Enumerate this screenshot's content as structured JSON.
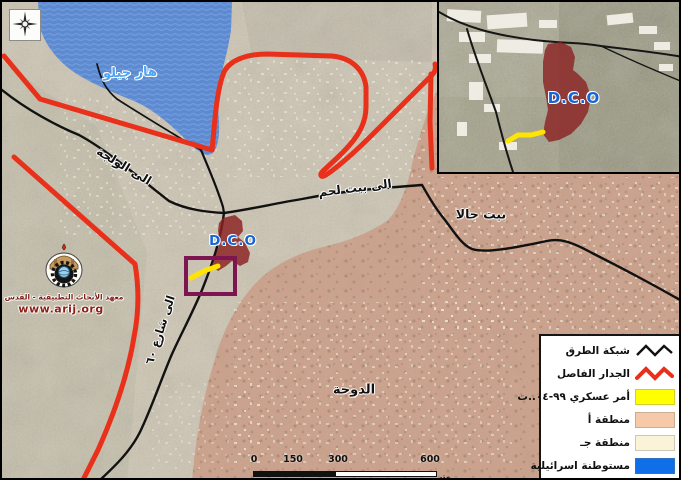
{
  "map": {
    "labels": {
      "har_gilo": "هار جيلو",
      "dco": "D.C.O",
      "to_walaja": "الى الولجة",
      "to_bethlehem": "الى بيت لحم",
      "beit_jala": "بيت جالا",
      "doha": "الدوحة",
      "to_road_60": "الى شارع ٦٠"
    },
    "colors": {
      "separation_wall": "#e8301a",
      "road_network": "#111111",
      "settlement_fill": "#4d82d4",
      "area_a_fill": "#c98268",
      "dco_compound": "#8b2121",
      "military_order_line": "#ffe400",
      "order_box_outline": "#7c1550",
      "label_blue": "#1565d8"
    }
  },
  "inset": {
    "dco_label": "D.C.O"
  },
  "logo": {
    "org_name": "معهد الأبحاث التطبيقية - القدس",
    "website": "www.arij.org"
  },
  "legend": {
    "items": [
      {
        "label": "شبكة الطرق",
        "symbol": "black-zigzag-line",
        "color": "#111111"
      },
      {
        "label": "الجدار الفاصل",
        "symbol": "red-zigzag-line",
        "color": "#e8301a"
      },
      {
        "label": "أمر عسكري ٩٩-٠٤..ت",
        "symbol": "swatch",
        "color": "#ffff00"
      },
      {
        "label": "منطقة أ",
        "symbol": "swatch",
        "color": "#f6caa8"
      },
      {
        "label": "منطقة جـ",
        "symbol": "swatch",
        "color": "#fbf3d8"
      },
      {
        "label": "مستوطنة اسرائيلية",
        "symbol": "swatch",
        "color": "#0e6fe9"
      }
    ]
  },
  "scalebar": {
    "ticks": [
      "0",
      "150",
      "300",
      "600"
    ],
    "unit": "متر"
  }
}
